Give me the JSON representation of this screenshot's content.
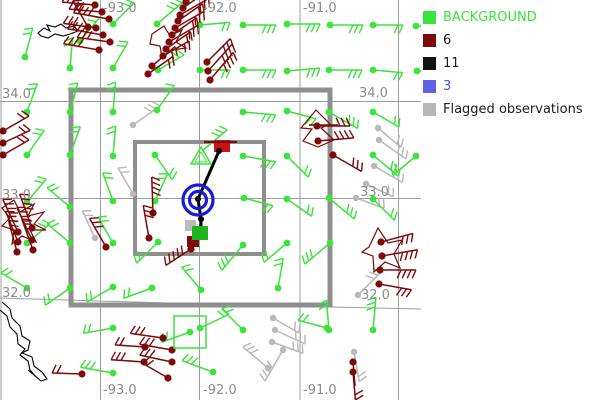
{
  "colors": {
    "background_obs": "#3be33b",
    "rejected_obs": "#7c0a0a",
    "flagged_obs": "#b8b8b8",
    "black_obs": "#000000",
    "blue_obs": "#1a1ad6",
    "grid_line": "#9d9d9d",
    "grid_label": "#8c8c8c",
    "box": "#8f8f8f",
    "coast": "#000000",
    "red_square": "#c41414",
    "green_square": "#1eb41e",
    "gray_square": "#bcbcbc",
    "dark_red_square": "#7c0a0a"
  },
  "legend": {
    "items": [
      {
        "label": "BACKGROUND",
        "swatch": "#3be33b",
        "text_color": "#3be33b"
      },
      {
        "label": "6",
        "swatch": "#7c0a0a",
        "text_color": "#1a1a1a"
      },
      {
        "label": "11",
        "swatch": "#111111",
        "text_color": "#1a1a1a"
      },
      {
        "label": "3",
        "swatch": "#6161e8",
        "text_color": "#5050e0"
      },
      {
        "label": "Flagged observations",
        "swatch": "#b8b8b8",
        "text_color": "#1a1a1a"
      }
    ]
  },
  "grid": {
    "meridians": [
      {
        "label": "-93.0",
        "x": 100.5,
        "label_x": 103
      },
      {
        "label": "-92.0",
        "x": 199.5,
        "label_x": 203
      },
      {
        "label": "-91.0",
        "x": 300,
        "label_x": 303
      },
      {
        "label": "",
        "x": 398.5,
        "label_x": -100
      },
      {
        "label": "",
        "x": 1,
        "label_x": -100
      }
    ],
    "top_label_y": 12,
    "bottom_label_y": 394,
    "parallels": [
      {
        "label": "34.0",
        "y": 101.5,
        "left_x": 2,
        "right_x": 359,
        "label_y_left": 98,
        "label_y_right": 97
      },
      {
        "label": "33.0",
        "y": 198.5,
        "left_x": 2,
        "right_x": 360,
        "label_y_left": 199,
        "label_y_right": 196
      },
      {
        "label": "32.0",
        "y": 0,
        "left_x": 2,
        "right_x": 361,
        "label_y_left": 297,
        "label_y_right": 299,
        "path": "M0,298 L200,304 L421,309"
      }
    ]
  },
  "boxes": {
    "outer": {
      "x": 71,
      "y": 90,
      "w": 259,
      "h": 215,
      "stroke_w": 5
    },
    "inner": {
      "x": 135,
      "y": 142,
      "w": 129,
      "h": 112,
      "stroke_w": 4
    }
  },
  "highlight_square": {
    "x": 174,
    "y": 316,
    "size": 32
  },
  "center_symbols": {
    "blue_target": {
      "cx": 198,
      "cy": 200,
      "r_outer": 15,
      "r_inner": 8.5,
      "stroke_w": 3.2
    },
    "black_polyline": "219,151 198,199 201,219 201,227",
    "black_dots": [
      [
        219,
        151
      ],
      [
        198,
        199
      ],
      [
        201,
        219
      ]
    ],
    "red_square": {
      "x": 214,
      "y": 140,
      "w": 16,
      "h": 12
    },
    "red_square_bar": {
      "x1": 204,
      "y1": 142,
      "x2": 237,
      "y2": 142
    },
    "green_square": {
      "x": 192,
      "y": 226,
      "w": 16,
      "h": 14
    },
    "gray_square": {
      "x": 185,
      "y": 220,
      "w": 11,
      "h": 11
    },
    "dark_red_square": {
      "x": 187,
      "y": 236,
      "w": 12,
      "h": 11
    },
    "green_triangle_outer": "201,147 191,164 211,164",
    "green_triangle_inner": "201,152 195,162 207,162"
  },
  "stations": {
    "background": [
      [
        80,
        41,
        -50,
        2,
        -1
      ],
      [
        113,
        24,
        -45,
        2,
        -1
      ],
      [
        157,
        24,
        -40,
        3,
        -1
      ],
      [
        200,
        25,
        -5,
        2,
        1
      ],
      [
        243,
        25,
        0,
        3,
        1
      ],
      [
        287,
        24,
        0,
        3,
        1
      ],
      [
        330,
        25,
        0,
        3,
        1
      ],
      [
        373,
        25,
        0,
        2,
        1
      ],
      [
        416,
        26,
        5,
        2,
        1
      ],
      [
        25,
        57,
        -75,
        2,
        -1
      ],
      [
        70,
        68,
        -85,
        2,
        -1
      ],
      [
        113,
        68,
        -60,
        2,
        -1
      ],
      [
        158,
        70,
        -30,
        2,
        -1
      ],
      [
        200,
        70,
        0,
        2,
        1
      ],
      [
        243,
        70,
        0,
        3,
        1
      ],
      [
        287,
        71,
        -5,
        3,
        1
      ],
      [
        329,
        70,
        0,
        3,
        1
      ],
      [
        373,
        70,
        5,
        2,
        1
      ],
      [
        417,
        71,
        5,
        2,
        1
      ],
      [
        27,
        112,
        -70,
        2,
        -1
      ],
      [
        70,
        112,
        -75,
        2,
        -1
      ],
      [
        113,
        112,
        -85,
        2,
        -1
      ],
      [
        157,
        110,
        -55,
        2,
        -1
      ],
      [
        243,
        112,
        5,
        3,
        1
      ],
      [
        287,
        111,
        15,
        2,
        1
      ],
      [
        329,
        112,
        30,
        3,
        -1
      ],
      [
        373,
        112,
        30,
        2,
        -1
      ],
      [
        27,
        155,
        -55,
        2,
        -1
      ],
      [
        70,
        155,
        -70,
        2,
        -1
      ],
      [
        113,
        156,
        -85,
        2,
        -1
      ],
      [
        155,
        155,
        55,
        2,
        -1
      ],
      [
        243,
        156,
        10,
        3,
        1
      ],
      [
        287,
        156,
        45,
        2,
        -1
      ],
      [
        373,
        155,
        40,
        3,
        -1
      ],
      [
        416,
        156,
        140,
        2,
        1
      ],
      [
        27,
        202,
        -50,
        2,
        -1
      ],
      [
        70,
        207,
        -140,
        2,
        1
      ],
      [
        113,
        201,
        -110,
        2,
        1
      ],
      [
        155,
        201,
        -65,
        2,
        -1
      ],
      [
        244,
        198,
        15,
        2,
        1
      ],
      [
        287,
        199,
        35,
        2,
        -1
      ],
      [
        329,
        198,
        40,
        3,
        -1
      ],
      [
        373,
        199,
        45,
        2,
        -1
      ],
      [
        27,
        243,
        -40,
        2,
        -1
      ],
      [
        70,
        243,
        -140,
        2,
        1
      ],
      [
        113,
        243,
        -120,
        2,
        1
      ],
      [
        158,
        242,
        135,
        2,
        1
      ],
      [
        243,
        245,
        130,
        3,
        1
      ],
      [
        287,
        243,
        140,
        2,
        1
      ],
      [
        330,
        243,
        140,
        3,
        1
      ],
      [
        27,
        288,
        -150,
        2,
        1
      ],
      [
        70,
        288,
        145,
        2,
        1
      ],
      [
        113,
        287,
        150,
        2,
        1
      ],
      [
        152,
        288,
        160,
        2,
        1
      ],
      [
        201,
        290,
        -130,
        2,
        1
      ],
      [
        278,
        288,
        -80,
        2,
        -1
      ],
      [
        113,
        328,
        170,
        2,
        1
      ],
      [
        190,
        332,
        160,
        2,
        1
      ],
      [
        200,
        328,
        -25,
        2,
        -1,
        32
      ],
      [
        243,
        330,
        -135,
        2,
        1
      ],
      [
        327,
        328,
        -165,
        2,
        1
      ],
      [
        329,
        330,
        -95,
        2,
        -1
      ],
      [
        373,
        330,
        -85,
        3,
        -1
      ],
      [
        113,
        373,
        -170,
        3,
        1
      ],
      [
        213,
        372,
        -160,
        3,
        1
      ]
    ],
    "rejected": [
      [
        95,
        5,
        -175,
        3,
        1
      ],
      [
        102,
        12,
        -175,
        3,
        1
      ],
      [
        109,
        19,
        -170,
        4,
        1
      ],
      [
        96,
        28,
        -172,
        3,
        1
      ],
      [
        103,
        35,
        -170,
        4,
        1
      ],
      [
        110,
        42,
        -172,
        3,
        1
      ],
      [
        99,
        50,
        -170,
        4,
        1
      ],
      [
        88,
        27,
        -120,
        2,
        1
      ],
      [
        3,
        131,
        -30,
        2,
        -1
      ],
      [
        3,
        143,
        -25,
        2,
        -1
      ],
      [
        3,
        155,
        -30,
        2,
        -1
      ],
      [
        186,
        2,
        -35,
        2,
        1
      ],
      [
        183,
        8,
        -35,
        2,
        1
      ],
      [
        180,
        15,
        -30,
        3,
        1
      ],
      [
        178,
        21,
        -35,
        2,
        1
      ],
      [
        175,
        28,
        -30,
        3,
        1
      ],
      [
        172,
        35,
        -35,
        2,
        1
      ],
      [
        169,
        42,
        -30,
        3,
        1
      ],
      [
        166,
        49,
        -35,
        2,
        1
      ],
      [
        163,
        56,
        -30,
        2,
        1
      ],
      [
        152,
        66,
        -40,
        2,
        1
      ],
      [
        148,
        74,
        -35,
        2,
        1
      ],
      [
        207,
        62,
        -45,
        3,
        1
      ],
      [
        208,
        71,
        -48,
        4,
        1
      ],
      [
        210,
        80,
        -50,
        4,
        1
      ],
      [
        18,
        232,
        -115,
        4,
        1
      ],
      [
        32,
        228,
        -110,
        4,
        1
      ],
      [
        18,
        242,
        -112,
        3,
        1
      ],
      [
        32,
        240,
        -115,
        4,
        1
      ],
      [
        17,
        252,
        -105,
        3,
        1
      ],
      [
        33,
        250,
        -110,
        3,
        1
      ],
      [
        153,
        213,
        -92,
        4,
        1
      ],
      [
        149,
        238,
        -100,
        3,
        1
      ],
      [
        106,
        247,
        -120,
        3,
        1
      ],
      [
        163,
        338,
        -172,
        3,
        1
      ],
      [
        145,
        347,
        -176,
        2,
        1
      ],
      [
        172,
        350,
        -170,
        3,
        1
      ],
      [
        144,
        362,
        -176,
        3,
        1
      ],
      [
        172,
        362,
        -168,
        3,
        1
      ],
      [
        82,
        374,
        -178,
        2,
        1
      ],
      [
        168,
        378,
        -150,
        2,
        1
      ],
      [
        191,
        249,
        147,
        5,
        1,
        30
      ],
      [
        317,
        126,
        0,
        3,
        -1
      ],
      [
        318,
        141,
        -5,
        4,
        -1
      ],
      [
        333,
        155,
        30,
        3,
        -1
      ],
      [
        381,
        242,
        -15,
        3,
        1
      ],
      [
        382,
        256,
        -10,
        4,
        1
      ],
      [
        380,
        270,
        0,
        4,
        1
      ],
      [
        379,
        284,
        10,
        3,
        1
      ],
      [
        353,
        362,
        85,
        0,
        1
      ],
      [
        353,
        372,
        85,
        3,
        -1
      ]
    ],
    "flagged": [
      [
        133,
        125,
        -35,
        3,
        -1
      ],
      [
        133,
        194,
        -120,
        2,
        1
      ],
      [
        95,
        238,
        -115,
        2,
        1
      ],
      [
        378,
        128,
        40,
        2,
        -1
      ],
      [
        379,
        140,
        35,
        3,
        -1
      ],
      [
        374,
        166,
        30,
        3,
        -1
      ],
      [
        366,
        184,
        25,
        2,
        -1
      ],
      [
        356,
        198,
        20,
        2,
        -1
      ],
      [
        273,
        318,
        30,
        2,
        -1
      ],
      [
        275,
        330,
        25,
        3,
        -1
      ],
      [
        272,
        342,
        20,
        3,
        -1
      ],
      [
        354,
        352,
        80,
        2,
        -1
      ],
      [
        283,
        350,
        120,
        4,
        1
      ],
      [
        268,
        368,
        -140,
        3,
        1
      ],
      [
        358,
        295,
        -45,
        3,
        -1
      ]
    ]
  },
  "extra_barbs": [
    {
      "x": 202,
      "y": 151,
      "a": -40,
      "t": 3,
      "s": -1,
      "c": "background_obs"
    }
  ],
  "extra_lines": [
    {
      "x1": 309,
      "y1": 125,
      "x2": 338,
      "y2": 125,
      "c": "rejected_obs",
      "w": 1.5
    }
  ],
  "shapes": {
    "coastlines": [
      "M38,33 L44,28 L50,31 L47,25 L55,27 L61,24 L66,28 L74,26 L78,31 L70,34 L63,36 L55,34 L48,38 L41,36 Z",
      "M2,302 L10,309 L12,318 L20,326 L22,336 L30,341 L28,350 L22,353 L32,357 L34,366 L42,372 L47,379 L41,381 L34,375 L28,370",
      "M0,310 L7,316 L10,327 L17,334 L18,344 L25,349 L20,355 L28,361 L30,370 L36,377"
    ],
    "spikes": [
      "M2,208 L14,200 L20,212 L34,204 L28,216 L44,212 L34,224 L46,230 L30,230 L36,242 L22,236 L12,244 L14,230 L2,226 L10,218 Z",
      "M152,34 L164,26 L170,36 L182,30 L176,42 L186,48 L172,50 L162,58 L160,46 L150,44 Z",
      "M301,128 L316,110 L330,124 L321,128 L334,140 L318,147 L303,141 L312,129 Z",
      "M369,247 L378,228 L388,243 L402,240 L394,254 L400,268 L385,262 L374,272 L373,256 L362,252 Z"
    ]
  }
}
